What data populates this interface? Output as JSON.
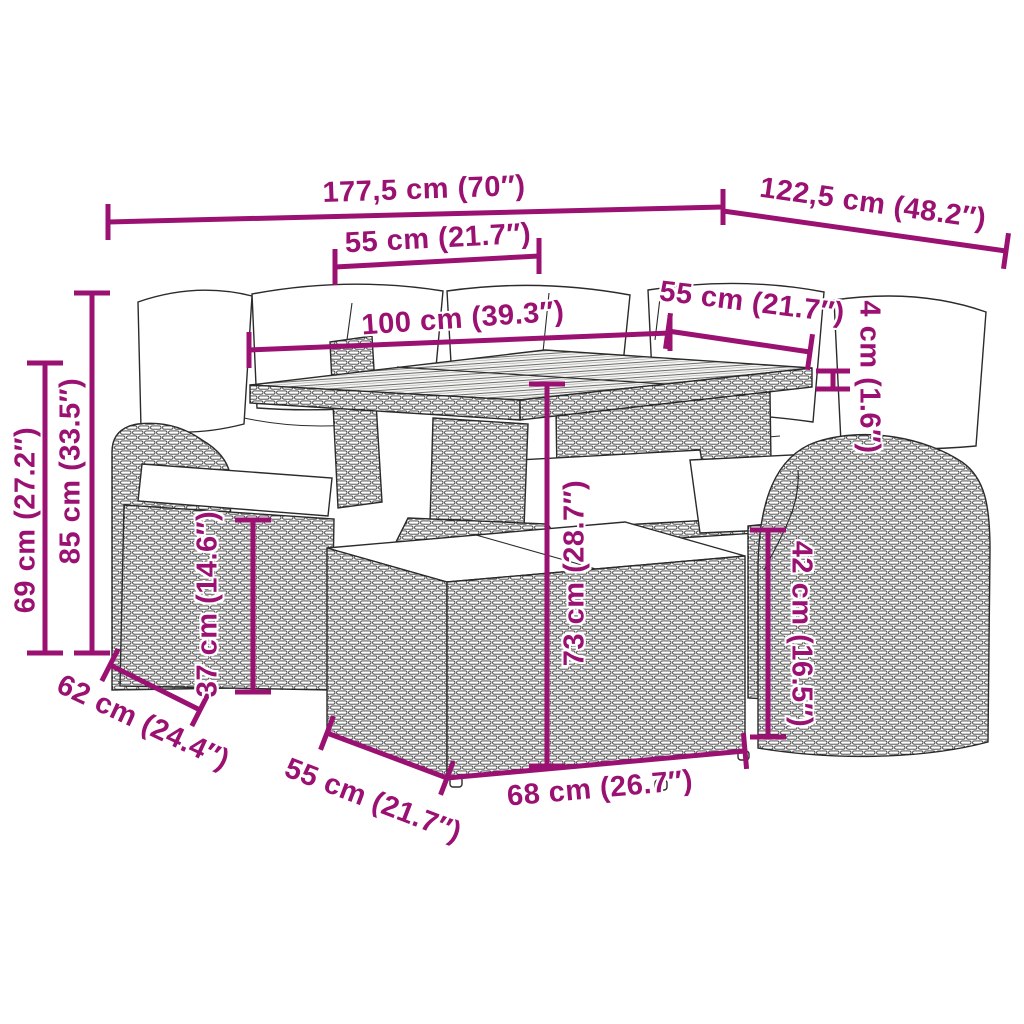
{
  "diagram": {
    "kind": "product-dimension-diagram",
    "subject": "poly rattan garden lounge set with table and ottomans",
    "annotation_color": "#9a1172",
    "line_art_color": "#2b2b2b",
    "background_color": "#ffffff"
  },
  "dims": {
    "total_width": {
      "label": "177,5 cm (70″)"
    },
    "total_depth": {
      "label": "122,5 cm (48.2″)"
    },
    "seat_width_left": {
      "label": "55 cm (21.7″)"
    },
    "table_length": {
      "label": "100 cm (39.3″)"
    },
    "seat_width_right": {
      "label": "55 cm (21.7″)"
    },
    "tabletop_thickness": {
      "label": "4 cm (1.6″)"
    },
    "back_height": {
      "label": "85 cm (33.5″)"
    },
    "armrest_height": {
      "label": "69 cm (27.2″)"
    },
    "seat_height_left": {
      "label": "37 cm (14.6″)"
    },
    "table_height": {
      "label": "73 cm (28.7″)"
    },
    "seat_height_right": {
      "label": "42 cm (16.5″)"
    },
    "seat_depth_left": {
      "label": "62 cm (24.4″)"
    },
    "ottoman_depth": {
      "label": "55 cm (21.7″)"
    },
    "ottoman_width": {
      "label": "68 cm (26.7″)"
    }
  }
}
